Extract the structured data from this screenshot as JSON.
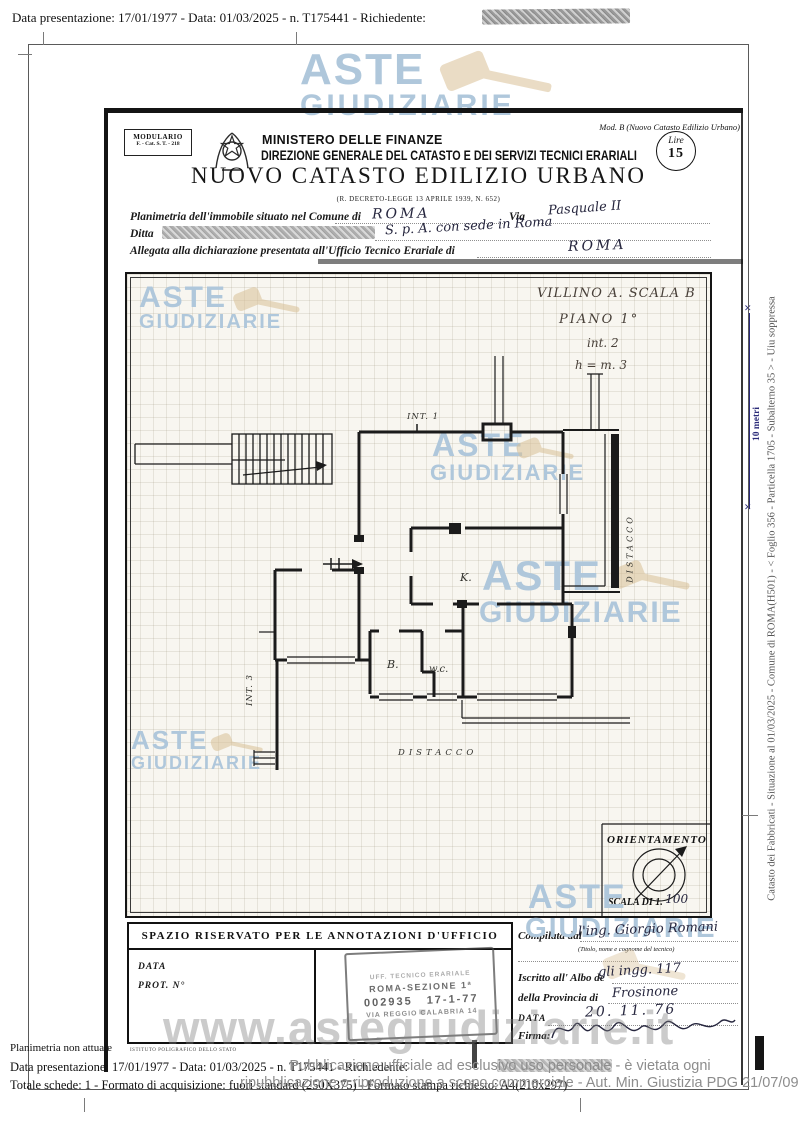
{
  "top": {
    "line": "Data presentazione: 17/01/1977 - Data: 01/03/2025 - n. T175441 - Richiedente:"
  },
  "doc": {
    "modulario1": "MODULARIO",
    "modulario2": "F. - Cat. S. T. - 218",
    "ministry": "MINISTERO DELLE FINANZE",
    "direction": "DIREZIONE GENERALE DEL CATASTO E DEI SERVIZI TECNICI ERARIALI",
    "mod_b": "Mod. B (Nuovo Catasto Edilizio Urbano)",
    "lire_label": "Lire",
    "lire_value": "15",
    "title": "NUOVO CATASTO EDILIZIO URBANO",
    "subtitle": "(R. DECRETO-LEGGE 13 APRILE 1939, N. 652)"
  },
  "form": {
    "l1": "Planimetria dell'immobile situato nel Comune di",
    "l1_value": "ROMA",
    "via": "Via",
    "via_value": "Pasquale II",
    "ditta": "Ditta",
    "ditta_value": "S. p. A. con sede in Roma",
    "l3": "Allegata alla dichiarazione presentata all'Ufficio Tecnico Erariale di",
    "l3_value": "ROMA"
  },
  "plan": {
    "notes": [
      "VILLINO A. SCALA B",
      "PIANO 1°",
      "int. 2",
      "h = m. 3"
    ],
    "int1": "INT. 1",
    "int3": "INT. 3",
    "k": "K.",
    "b": "B.",
    "wc": "w.c.",
    "distacco_bottom": "DISTACCO",
    "distacco_right": "DISTACCO",
    "orient_title": "ORIENTAMENTO",
    "scala_label": "SCALA DI 1.",
    "scala_value": "100"
  },
  "office": {
    "title": "SPAZIO RISERVATO PER LE ANNOTAZIONI D'UFFICIO",
    "data": "DATA",
    "prot": "PROT. N°",
    "printer": "ISTITUTO POLIGRAFICO DELLO STATO"
  },
  "stamp": {
    "l1": "UFF. TECNICO ERARIALE",
    "l2": "ROMA-SEZIONE 1ª",
    "num": "002935",
    "date": "17-1-77",
    "l4": "VIA REGGIO CALABRIA 14"
  },
  "tech": {
    "compiled": "Compilata dal",
    "compiled_value": "l'ing. Giorgio Romani",
    "hint": "(Titolo, nome e cognome del tecnico)",
    "albo": "Iscritto all' Albo de",
    "albo_value": "gli ingg. 117",
    "prov": "della Provincia di",
    "prov_value": "Frosinone",
    "data_label": "DATA",
    "data_value": "20. 11. 76",
    "firma": "Firma:"
  },
  "wm": {
    "a": "ASTE",
    "g": "GIUDIZIARIE",
    "url": "www.astegiudiziarie.it"
  },
  "side": {
    "note": "Catasto dei Fabbricati - Situazione al 01/03/2025 - Comune di ROMA(H501) -  <  Foglio 356 - Particella 1705 - Subalterno 35 >  - Uiu soppressa",
    "scale": "10 metri"
  },
  "foot": {
    "plan_note": "Planimetria non attuale",
    "line1": "Data presentazione: 17/01/1977 - Data: 01/03/2025 - n. T175441 - Richiedente:",
    "line2": "Totale schede: 1 - Formato di acquisizione: fuori standard (250X375) - Formato stampa richiesto: A4(210x297)",
    "ov1": "Pubblicazione ufficiale ad esclusivo uso personale - è vietata ogni",
    "ov2": "ripubblicazione o riproduzione a scopo commerciale - Aut. Min. Giustizia PDG 21/07/09"
  },
  "colors": {
    "watermark_blue": "#afc7db",
    "gavel_tan": "#d9c096",
    "ink": "#26263e",
    "scale_blue": "#2a2a78",
    "stamp_gray": "#474747",
    "overlay_gray": "#8d8d8d"
  }
}
